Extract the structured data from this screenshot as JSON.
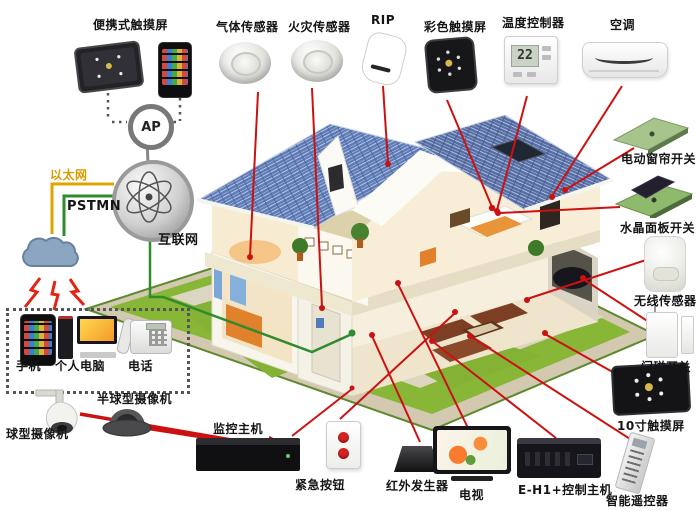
{
  "wireless_group": {
    "title": "便携式触摸屏",
    "ap_label": "AP"
  },
  "network": {
    "ethernet_label": "以太网",
    "pstn_label": "PSTMN",
    "internet_label": "互联网"
  },
  "top_row": {
    "items": [
      {
        "id": "gas-sensor",
        "label": "气体传感器"
      },
      {
        "id": "fire-sensor",
        "label": "火灾传感器"
      },
      {
        "id": "pir-sensor",
        "label": "RIP"
      },
      {
        "id": "color-touchscreen",
        "label": "彩色触摸屏"
      },
      {
        "id": "temperature-controller",
        "label": "温度控制器",
        "reading": "22"
      },
      {
        "id": "air-conditioner",
        "label": "空调"
      }
    ]
  },
  "right_col": {
    "items": [
      {
        "id": "curtain-switch",
        "label": "电动窗帘开关"
      },
      {
        "id": "crystal-panel-switch",
        "label": "水晶面板开关"
      },
      {
        "id": "wireless-sensor",
        "label": "无线传感器"
      },
      {
        "id": "door-magnet-switch",
        "label": "门磁开关"
      },
      {
        "id": "touchscreen-10inch",
        "label": "10寸触摸屏"
      },
      {
        "id": "smart-remote",
        "label": "智能遥控器"
      }
    ]
  },
  "bottom_row": {
    "items": [
      {
        "id": "surveillance-host",
        "label": "监控主机"
      },
      {
        "id": "emergency-button",
        "label": "紧急按钮"
      },
      {
        "id": "ir-generator",
        "label": "红外发生器"
      },
      {
        "id": "tv",
        "label": "电视"
      },
      {
        "id": "control-host",
        "label": "E-H1+控制主机"
      }
    ]
  },
  "terminal_box": {
    "items": [
      {
        "id": "mobile-phone",
        "label": "手机"
      },
      {
        "id": "personal-computer",
        "label": "个人电脑"
      },
      {
        "id": "telephone",
        "label": "电话"
      }
    ]
  },
  "cameras": {
    "items": [
      {
        "id": "speed-dome-camera",
        "label": "球型摄像机"
      },
      {
        "id": "dome-camera",
        "label": "半球型摄像机"
      }
    ]
  },
  "colors": {
    "annotation_red": "#cc1111",
    "ethernet_yellow": "#d89b00",
    "pstn_green": "#2e8b2e",
    "roof_blue": "#5e7cb8",
    "grass_green": "#88b637"
  }
}
